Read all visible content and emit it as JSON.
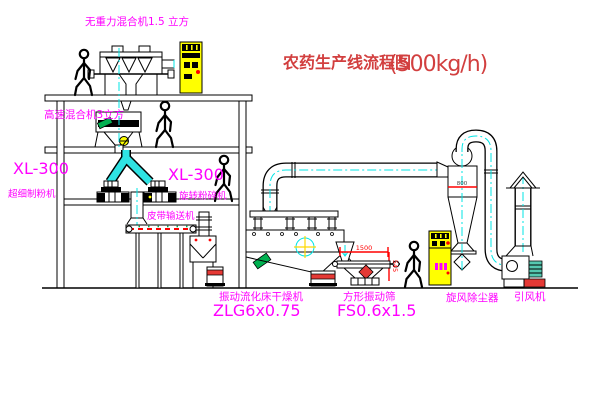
{
  "diagram": {
    "title": "农药生产线流程图",
    "title_capacity": "(500kg/h)",
    "equipment_labels": {
      "gravity_mixer": "无重力混合机1.5 立方",
      "high_speed_mixer": "高速混合机3立方",
      "mill_left_model": "XL-300",
      "mill_left_name": "超细制粉机",
      "mill_center_model": "XL-300",
      "mill_center_name": "旋转粉碎机",
      "belt_conveyor": "皮带输送机",
      "fluid_bed_dryer": "振动流化床干燥机",
      "fluid_bed_dryer_model": "ZLG6x0.75",
      "vibrating_screen": "方形振动筛",
      "vibrating_screen_model": "FS0.6x1.5",
      "cyclone": "旋风除尘器",
      "induced_draft_fan": "引风机"
    },
    "dimensions": {
      "screen_length": "1500",
      "screen_height": "545",
      "cyclone_diameter": "800"
    },
    "colors": {
      "label_magenta": "#FF00FF",
      "title_red": "#D23F3F",
      "centerline_cyan": "#00E5E5",
      "cabinet_yellow": "#FFFF00",
      "accent_red": "#FF0000",
      "motor_green": "#00B050",
      "line_black": "#000000",
      "background": "#FFFFFF"
    }
  }
}
